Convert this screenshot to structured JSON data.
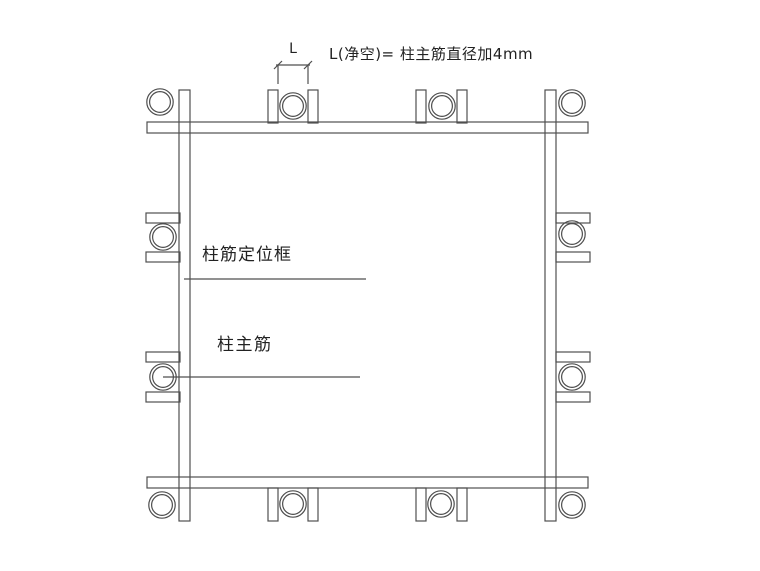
{
  "annotations": {
    "dim_label": "L",
    "formula": "L(净空)= 柱主筋直径加4mm",
    "frame_label": "柱筋定位框",
    "main_bar_label": "柱主筋"
  },
  "colors": {
    "line": "#4f4f4f",
    "text": "#222222",
    "background": "#ffffff"
  },
  "drawing": {
    "canvas": {
      "width": 760,
      "height": 571
    },
    "strips": [
      {
        "name": "frame-strip-top",
        "x": 147,
        "y": 122,
        "w": 441,
        "h": 11
      },
      {
        "name": "frame-strip-bottom",
        "x": 147,
        "y": 477,
        "w": 441,
        "h": 11
      },
      {
        "name": "frame-strip-left",
        "x": 179,
        "y": 90,
        "w": 11,
        "h": 431
      },
      {
        "name": "frame-strip-right",
        "x": 545,
        "y": 90,
        "w": 11,
        "h": 431
      }
    ],
    "tabs": [
      {
        "name": "tab-top-1-left",
        "x": 268,
        "y": 90,
        "w": 10,
        "h": 33
      },
      {
        "name": "tab-top-1-right",
        "x": 308,
        "y": 90,
        "w": 10,
        "h": 33
      },
      {
        "name": "tab-top-2-left",
        "x": 416,
        "y": 90,
        "w": 10,
        "h": 33
      },
      {
        "name": "tab-top-2-right",
        "x": 457,
        "y": 90,
        "w": 10,
        "h": 33
      },
      {
        "name": "tab-bottom-1-left",
        "x": 268,
        "y": 488,
        "w": 10,
        "h": 33
      },
      {
        "name": "tab-bottom-1-right",
        "x": 308,
        "y": 488,
        "w": 10,
        "h": 33
      },
      {
        "name": "tab-bottom-2-left",
        "x": 416,
        "y": 488,
        "w": 10,
        "h": 33
      },
      {
        "name": "tab-bottom-2-right",
        "x": 457,
        "y": 488,
        "w": 10,
        "h": 33
      },
      {
        "name": "tab-left-1-upper",
        "x": 146,
        "y": 213,
        "w": 34,
        "h": 10
      },
      {
        "name": "tab-left-1-lower",
        "x": 146,
        "y": 252,
        "w": 34,
        "h": 10
      },
      {
        "name": "tab-left-2-upper",
        "x": 146,
        "y": 352,
        "w": 34,
        "h": 10
      },
      {
        "name": "tab-left-2-lower",
        "x": 146,
        "y": 392,
        "w": 34,
        "h": 10
      },
      {
        "name": "tab-right-1-upper",
        "x": 556,
        "y": 213,
        "w": 34,
        "h": 10
      },
      {
        "name": "tab-right-1-lower",
        "x": 556,
        "y": 252,
        "w": 34,
        "h": 10
      },
      {
        "name": "tab-right-2-upper",
        "x": 556,
        "y": 352,
        "w": 34,
        "h": 10
      },
      {
        "name": "tab-right-2-lower",
        "x": 556,
        "y": 392,
        "w": 34,
        "h": 10
      }
    ],
    "rebar_radius": {
      "outer": 13.2,
      "inner": 10.4
    },
    "rebars": [
      {
        "name": "rebar-corner-top-left",
        "cx": 160,
        "cy": 102
      },
      {
        "name": "rebar-top-1",
        "cx": 293,
        "cy": 106
      },
      {
        "name": "rebar-top-2",
        "cx": 442,
        "cy": 106
      },
      {
        "name": "rebar-corner-top-right",
        "cx": 572,
        "cy": 103
      },
      {
        "name": "rebar-left-1",
        "cx": 163,
        "cy": 237
      },
      {
        "name": "rebar-right-1",
        "cx": 572,
        "cy": 234
      },
      {
        "name": "rebar-left-2",
        "cx": 163,
        "cy": 377
      },
      {
        "name": "rebar-right-2",
        "cx": 572,
        "cy": 377
      },
      {
        "name": "rebar-corner-bottom-left",
        "cx": 162,
        "cy": 505
      },
      {
        "name": "rebar-bottom-1",
        "cx": 293,
        "cy": 504
      },
      {
        "name": "rebar-bottom-2",
        "cx": 441,
        "cy": 504
      },
      {
        "name": "rebar-corner-bottom-right",
        "cx": 572,
        "cy": 505
      }
    ],
    "lines": [
      {
        "name": "frame-label-leader",
        "x1": 184,
        "y1": 279,
        "x2": 366,
        "y2": 279
      },
      {
        "name": "main-bar-leader",
        "x1": 163,
        "y1": 377,
        "x2": 360,
        "y2": 377
      },
      {
        "name": "dim-line",
        "x1": 276,
        "y1": 65,
        "x2": 310,
        "y2": 65
      },
      {
        "name": "dim-ext-left",
        "x1": 278,
        "y1": 65,
        "x2": 278,
        "y2": 84
      },
      {
        "name": "dim-ext-right",
        "x1": 308,
        "y1": 65,
        "x2": 308,
        "y2": 84
      },
      {
        "name": "dim-tick-left",
        "x1": 274,
        "y1": 69,
        "x2": 282,
        "y2": 61
      },
      {
        "name": "dim-tick-right",
        "x1": 304,
        "y1": 69,
        "x2": 312,
        "y2": 61
      }
    ]
  }
}
